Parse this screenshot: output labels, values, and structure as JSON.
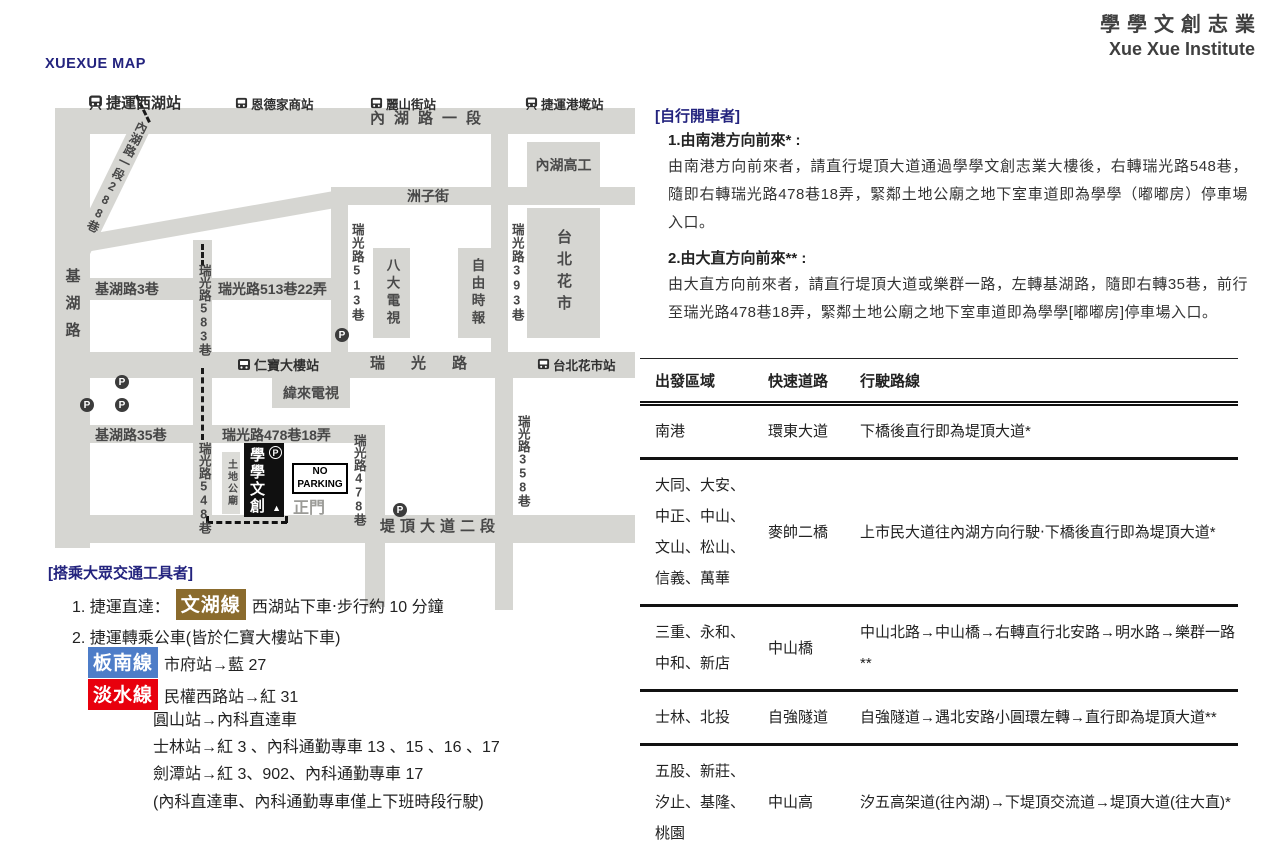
{
  "brand": {
    "cn": "學學文創志業",
    "en": "Xue Xue Institute"
  },
  "page_title": "XUEXUE MAP",
  "map": {
    "stations": {
      "xihu": "捷運西湖站",
      "ende": "恩德家商站",
      "lishan": "麗山街站",
      "gangqian": "捷運港墘站",
      "renbao": "仁寶大樓站",
      "huashi": "台北花市站"
    },
    "roads": {
      "neihu1": "內湖路一段",
      "neihu288": "內湖路一段288巷",
      "jihu": "基湖路",
      "jihu3": "基湖路3巷",
      "rg513_22": "瑞光路513巷22弄",
      "rg513": "瑞光路513巷",
      "rg393": "瑞光路393巷",
      "zhouzi": "洲子街",
      "rg583": "瑞光路583巷",
      "rg548": "瑞光路548巷",
      "ruiguang": "瑞光路",
      "jihu35": "基湖路35巷",
      "rg478_18": "瑞光路478巷18弄",
      "rg478": "瑞光路478巷",
      "rg358": "瑞光路358巷",
      "tiding2": "堤頂大道二段"
    },
    "blocks": {
      "neihu_school": "內湖高工",
      "flower_market": "台北花市",
      "bada": "八大電視",
      "liberty": "自由時報",
      "weilai": "緯來電視",
      "temple": "土地公廟",
      "xuexue": "學學文創",
      "gate": "正門"
    },
    "signs": {
      "no_parking_1": "NO",
      "no_parking_2": "PARKING",
      "parking": "P"
    }
  },
  "driving": {
    "header": "[自行開車者]",
    "sec1_title": "1.由南港方向前來* :",
    "sec1_body": "由南港方向前來者，請直行堤頂大道通過學學文創志業大樓後，右轉瑞光路548巷，隨即右轉瑞光路478巷18弄，緊鄰土地公廟之地下室車道即為學學（嘟嘟房）停車場入口。",
    "sec2_title": "2.由大直方向前來** :",
    "sec2_body": "由大直方向前來者，請直行堤頂大道或樂群一路，左轉基湖路，隨即右轉35巷，前行至瑞光路478巷18弄，緊鄰土地公廟之地下室車道即為學學[嘟嘟房]停車場入口。",
    "table": {
      "headers": [
        "出發區域",
        "快速道路",
        "行駛路線"
      ],
      "rows": [
        {
          "origin": "南港",
          "expressway": "環東大道",
          "route": "下橋後直行即為堤頂大道*"
        },
        {
          "origin": "大同、大安、中正、中山、文山、松山、信義、萬華",
          "expressway": "麥帥二橋",
          "route": "上市民大道往內湖方向行駛‧下橋後直行即為堤頂大道*"
        },
        {
          "origin": "三重、永和、中和、新店",
          "expressway": "中山橋",
          "route": "中山北路→中山橋→右轉直行北安路→明水路→樂群一路**"
        },
        {
          "origin": "士林、北投",
          "expressway": "自強隧道",
          "route": "自強隧道→遇北安路小圓環左轉→直行即為堤頂大道**"
        },
        {
          "origin": "五股、新莊、汐止、基隆、桃園",
          "expressway": "中山高",
          "route": "汐五高架道(往內湖)→下堤頂交流道→堤頂大道(往大直)*"
        }
      ]
    }
  },
  "transit": {
    "header": "[搭乘大眾交通工具者]",
    "item1_prefix": "1. 捷運直達：",
    "wenhu_badge": "文湖線",
    "item1_suffix": "西湖站下車‧步行約 10 分鐘",
    "item2": "2. 捷運轉乘公車(皆於仁寶大樓站下車)",
    "bannan_badge": "板南線",
    "bannan_text": "市府站→藍 27",
    "danshui_badge": "淡水線",
    "danshui_text": "民權西路站→紅 31",
    "extra_lines": [
      "圓山站→內科直達車",
      "士林站→紅 3 、內科通勤專車 13 、15 、16 、17",
      "劍潭站→紅 3、902、內科通勤專車 17",
      "(內科直達車、內科通勤專車僅上下班時段行駛)"
    ]
  },
  "colors": {
    "navy": "#23237e",
    "wenhu": "#8a6b2d",
    "bannan": "#4e7dc8",
    "danshui": "#e8000d",
    "road": "#d6d6d2"
  }
}
